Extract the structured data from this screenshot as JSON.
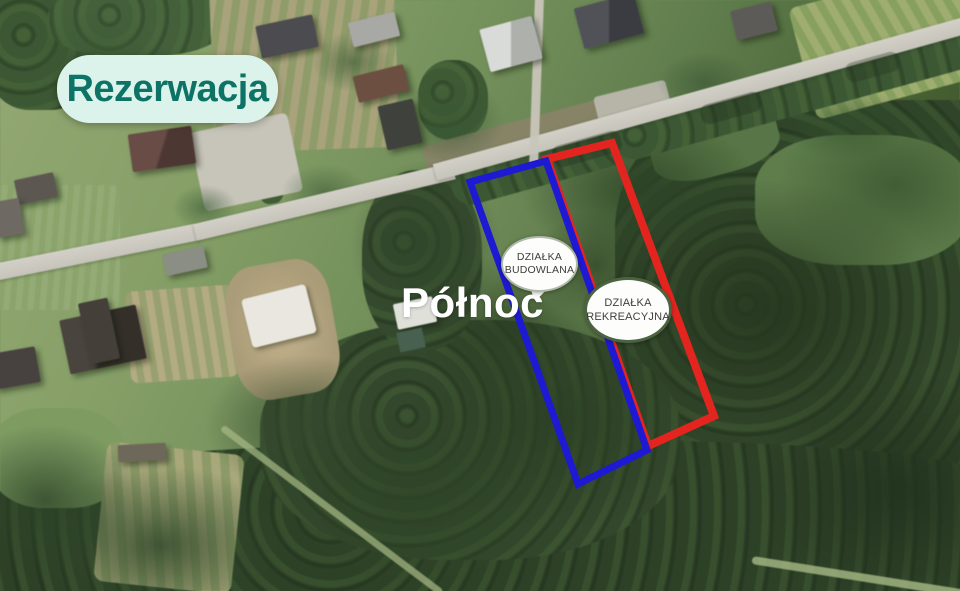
{
  "badge": {
    "label": "Rezerwacja",
    "bg_color": "#dbf3ea",
    "text_color": "#0d7366"
  },
  "north_label": "Północ",
  "plots": {
    "building": {
      "outline_color": "#1e19d2",
      "points": "470,182 546,161 647,450 578,484",
      "label": {
        "line1": "DZIAŁKA",
        "line2": "BUDOWLANA"
      }
    },
    "recreational": {
      "outline_color": "#e4251f",
      "points": "547,159 612,143 714,416 648,446",
      "label": {
        "line1": "DZIAŁKA",
        "line2": "REKREACYJNA"
      }
    }
  }
}
